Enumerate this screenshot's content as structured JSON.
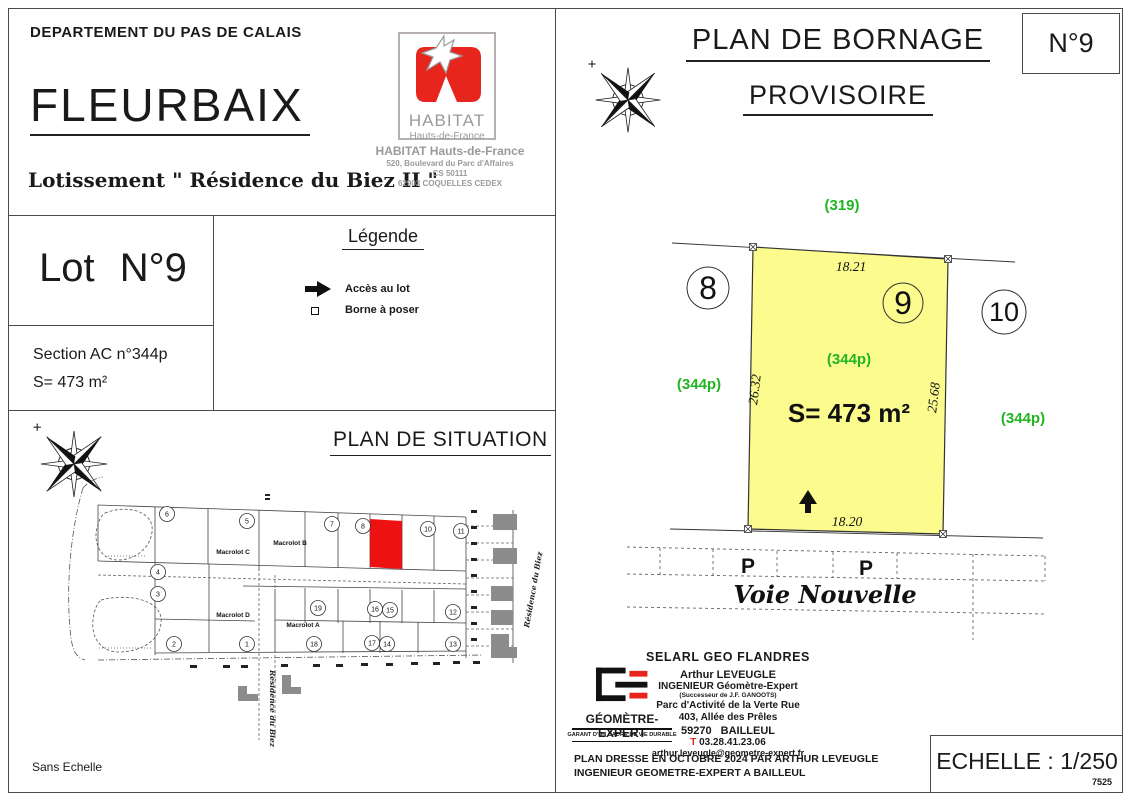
{
  "header": {
    "department": "DEPARTEMENT DU PAS DE CALAIS",
    "commune": "FLEURBAIX",
    "subdivision": "Lotissement \" Résidence du Biez II \""
  },
  "habitat": {
    "logo_title": "HABITAT",
    "logo_subtitle": "Hauts-de-France",
    "name": "HABITAT Hauts-de-France",
    "address1": "520, Boulevard du Parc d'Affaires",
    "address2": "CS 50111",
    "address3": "62903 COQUELLES CEDEX"
  },
  "lot_card": {
    "title": "Lot N°9",
    "section": "Section AC n°344p",
    "surface": "S= 473 m²"
  },
  "legend": {
    "title": "Légende",
    "access_label": "Accès au lot",
    "borne_label": "Borne à poser"
  },
  "situation": {
    "title": "PLAN DE SITUATION",
    "scale_note": "Sans Echelle",
    "macrolot_c": "Macrolot C",
    "macrolot_b": "Macrolot B",
    "macrolot_d": "Macrolot D",
    "macrolot_a": "Macrolot A",
    "street_vertical": "Résidence du Biez",
    "street_right": "Résidence du Biez",
    "lots": [
      "6",
      "5",
      "7",
      "8",
      "10",
      "11",
      "4",
      "3",
      "19",
      "16",
      "15",
      "12",
      "2",
      "1",
      "18",
      "17",
      "14",
      "13"
    ]
  },
  "bornage": {
    "title": "PLAN DE BORNAGE",
    "subtitle": "PROVISOIRE",
    "sheet": "N°9",
    "rear_parcel": "(319)",
    "dim_top": "18.21",
    "dim_left": "26.32",
    "dim_right": "25.68",
    "dim_bottom": "18.20",
    "lot_left": "8",
    "lot_current": "9",
    "lot_right": "10",
    "parcel_center": "(344p)",
    "parcel_left": "(344p)",
    "parcel_right": "(344p)",
    "surface": "S= 473 m²",
    "parking_left": "P",
    "parking_right": "P",
    "street": "Voie Nouvelle",
    "scale": "ECHELLE : 1/250",
    "plan_number": "7525"
  },
  "surveyor": {
    "company": "SELARL GEO FLANDRES",
    "name": "Arthur LEVEUGLE",
    "role": "INGENIEUR Géomètre-Expert",
    "successor": "(Successeur de J.F. GANOOTS)",
    "address1": "Parc d'Activité de la Verte Rue",
    "address2": "403, Allée des Prêles",
    "address3": "59270 BAILLEUL",
    "phone_t": "T",
    "phone": "03.28.41.23.06",
    "email": "arthur.leveugle@geometre-expert.fr",
    "logo_title": "GÉOMÈTRE-EXPERT",
    "logo_subtitle": "GARANT D'UN CADRE DE VIE DURABLE",
    "note1": "PLAN DRESSE EN OCTOBRE 2024 PAR ARTHUR LEVEUGLE",
    "note2": "INGENIEUR GEOMETRE-EXPERT A BAILLEUL"
  },
  "colors": {
    "lot_fill": "#fbfb8e",
    "green": "#22b422",
    "brand_red": "#e8251d",
    "logo_gray": "#9a9a9a"
  }
}
